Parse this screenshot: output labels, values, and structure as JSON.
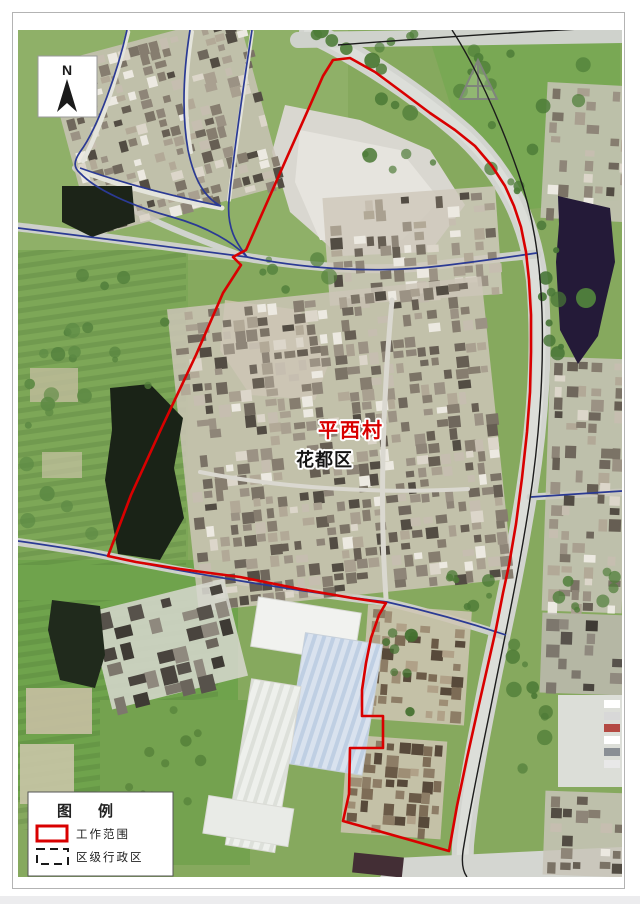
{
  "map": {
    "north_indicator": {
      "label": "N"
    },
    "labels": {
      "village": "平西村",
      "district": "花都区"
    },
    "legend": {
      "title": "图例",
      "items": [
        {
          "label": "工作范围",
          "symbol": "red-solid-rectangle-outline"
        },
        {
          "label": "区级行政区",
          "symbol": "black-dashed-rectangle-outline"
        }
      ]
    },
    "colors": {
      "work_boundary_red": "#d90000",
      "admin_boundary_blue": "#2b3a94",
      "road_line_black": "#1c1c1c",
      "legend_dash_black": "#1a1a1a",
      "village_label_red": "#d90000",
      "district_label_black": "#141414"
    }
  }
}
